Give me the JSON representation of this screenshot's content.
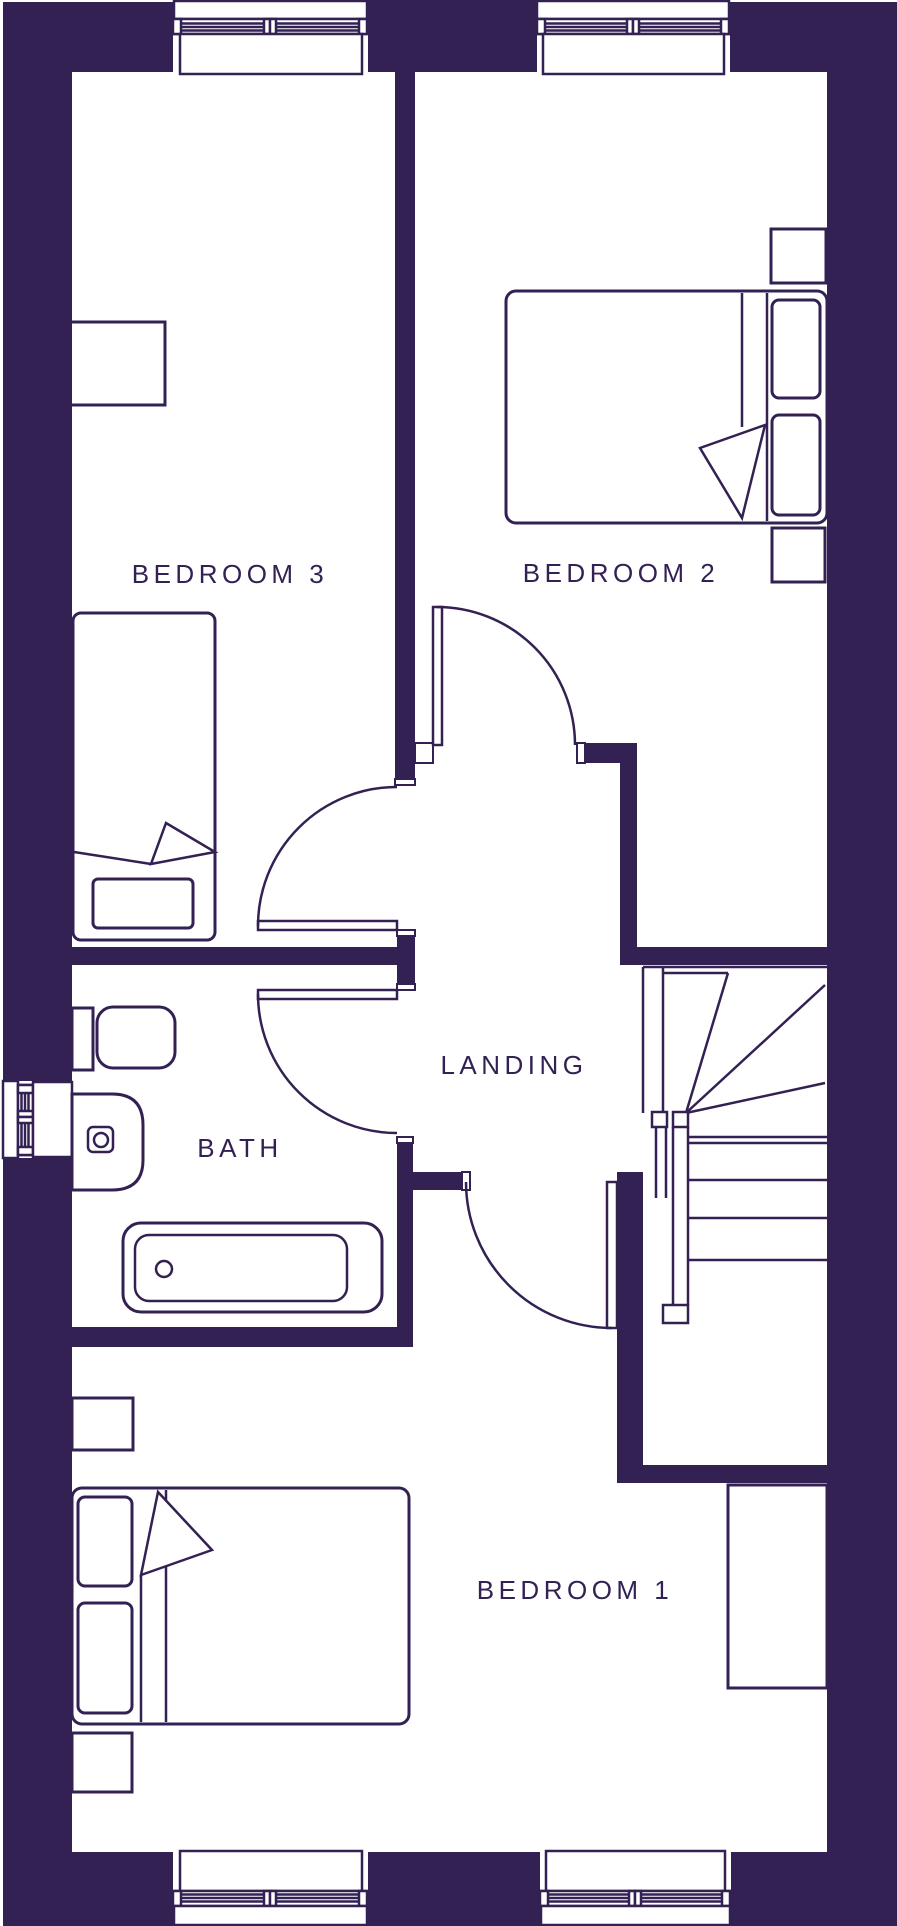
{
  "colors": {
    "wall": "#332153",
    "background": "#ffffff"
  },
  "rooms": {
    "bedroom3": {
      "label": "BEDROOM 3"
    },
    "bedroom2": {
      "label": "BEDROOM 2"
    },
    "landing": {
      "label": "LANDING"
    },
    "bath": {
      "label": "BATH"
    },
    "bedroom1": {
      "label": "BEDROOM 1"
    }
  }
}
